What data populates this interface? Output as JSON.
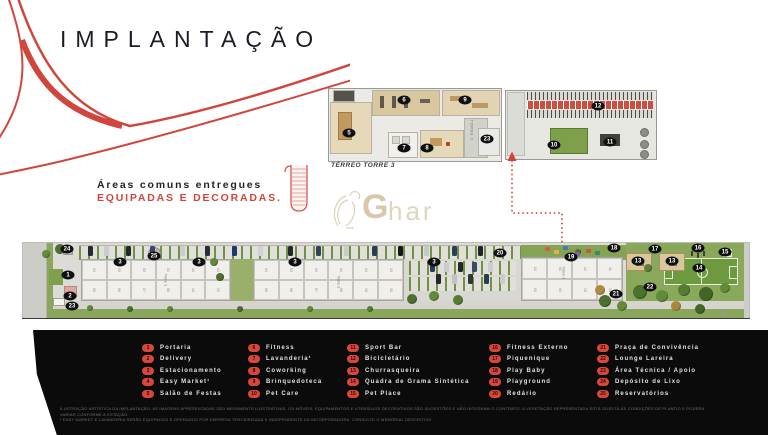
{
  "title": "IMPLANTAÇÃO",
  "tagline": {
    "line1": "Áreas comuns entregues",
    "line2": "EQUIPADAS E DECORADAS."
  },
  "watermark": {
    "bold": "G",
    "light": "har"
  },
  "colors": {
    "accent_red": "#d0453c",
    "footer_bg": "#0b0b0b",
    "gold": "#bfa374",
    "grass": "#8aa65c",
    "field_green": "#6d9a3e",
    "marker_black": "#0f0f0f"
  },
  "floorplan": {
    "caption": "TÉRREO TORRE 3",
    "tower_label": "TORRE 3",
    "markers": [
      {
        "n": "5",
        "x": 349,
        "y": 133
      },
      {
        "n": "6",
        "x": 404,
        "y": 100
      },
      {
        "n": "7",
        "x": 404,
        "y": 148
      },
      {
        "n": "8",
        "x": 427,
        "y": 148
      },
      {
        "n": "9",
        "x": 465,
        "y": 100
      },
      {
        "n": "23",
        "x": 487,
        "y": 139
      },
      {
        "n": "10",
        "x": 554,
        "y": 145
      },
      {
        "n": "11",
        "x": 610,
        "y": 142
      },
      {
        "n": "12",
        "x": 598,
        "y": 106
      }
    ]
  },
  "siteplan": {
    "tower_labels": [
      {
        "label": "Torre 1",
        "x": 166,
        "y": 280
      },
      {
        "label": "Torre 2",
        "x": 339,
        "y": 282
      },
      {
        "label": "Torre 3",
        "x": 564,
        "y": 273
      }
    ],
    "markers": [
      {
        "n": "24",
        "x": 67,
        "y": 249
      },
      {
        "n": "3",
        "x": 120,
        "y": 262
      },
      {
        "n": "25",
        "x": 154,
        "y": 256
      },
      {
        "n": "3",
        "x": 199,
        "y": 262
      },
      {
        "n": "1",
        "x": 68,
        "y": 275
      },
      {
        "n": "2",
        "x": 70,
        "y": 296
      },
      {
        "n": "23",
        "x": 72,
        "y": 306
      },
      {
        "n": "3",
        "x": 295,
        "y": 262
      },
      {
        "n": "3",
        "x": 434,
        "y": 262
      },
      {
        "n": "20",
        "x": 500,
        "y": 253
      },
      {
        "n": "19",
        "x": 571,
        "y": 257
      },
      {
        "n": "18",
        "x": 614,
        "y": 248
      },
      {
        "n": "17",
        "x": 655,
        "y": 249
      },
      {
        "n": "16",
        "x": 698,
        "y": 248
      },
      {
        "n": "15",
        "x": 725,
        "y": 252
      },
      {
        "n": "13",
        "x": 638,
        "y": 261
      },
      {
        "n": "13",
        "x": 672,
        "y": 261
      },
      {
        "n": "14",
        "x": 699,
        "y": 268
      },
      {
        "n": "22",
        "x": 650,
        "y": 287
      },
      {
        "n": "21",
        "x": 616,
        "y": 294
      }
    ],
    "buildings": [
      {
        "x": 58,
        "y": 16,
        "w": 150,
        "h": 42,
        "units_top": [
          "04",
          "03",
          "03",
          "01",
          "14",
          "13"
        ],
        "units_bottom": [
          "05",
          "06",
          "07",
          "08",
          "16",
          "15"
        ]
      },
      {
        "x": 230,
        "y": 16,
        "w": 151,
        "h": 42,
        "units_top": [
          "04",
          "03",
          "02",
          "01",
          "14",
          "13"
        ],
        "units_bottom": [
          "05",
          "06",
          "07",
          "08",
          "16",
          "15"
        ]
      },
      {
        "x": 498,
        "y": 14,
        "w": 102,
        "h": 44,
        "units_top": [
          "02",
          "01",
          "12",
          "11"
        ],
        "units_bottom": [
          "03",
          "04",
          "13",
          "14"
        ]
      }
    ],
    "cars": [
      {
        "x": 88,
        "y": 246,
        "c": "#262b33"
      },
      {
        "x": 104,
        "y": 246,
        "c": "#c9cbcd"
      },
      {
        "x": 126,
        "y": 246,
        "c": "#1f2730"
      },
      {
        "x": 150,
        "y": 246,
        "c": "#3a4a66"
      },
      {
        "x": 180,
        "y": 246,
        "c": "#caccce"
      },
      {
        "x": 205,
        "y": 246,
        "c": "#2a2f36"
      },
      {
        "x": 232,
        "y": 246,
        "c": "#1d3a6b"
      },
      {
        "x": 258,
        "y": 246,
        "c": "#cfd1d2"
      },
      {
        "x": 288,
        "y": 246,
        "c": "#23272c"
      },
      {
        "x": 316,
        "y": 246,
        "c": "#33405a"
      },
      {
        "x": 344,
        "y": 246,
        "c": "#c9cbcd"
      },
      {
        "x": 372,
        "y": 246,
        "c": "#2c3b57"
      },
      {
        "x": 398,
        "y": 246,
        "c": "#14161a"
      },
      {
        "x": 424,
        "y": 246,
        "c": "#c5c7c9"
      },
      {
        "x": 452,
        "y": 246,
        "c": "#2e3d5c"
      },
      {
        "x": 478,
        "y": 246,
        "c": "#1f242b"
      },
      {
        "x": 430,
        "y": 262,
        "c": "#2b3a55"
      },
      {
        "x": 444,
        "y": 262,
        "c": "#c9cbcd"
      },
      {
        "x": 458,
        "y": 262,
        "c": "#23272c"
      },
      {
        "x": 472,
        "y": 262,
        "c": "#3a4a66"
      },
      {
        "x": 488,
        "y": 262,
        "c": "#caccce"
      },
      {
        "x": 436,
        "y": 274,
        "c": "#1f2730"
      },
      {
        "x": 452,
        "y": 274,
        "c": "#c0c2c4"
      },
      {
        "x": 468,
        "y": 274,
        "c": "#30363d"
      },
      {
        "x": 484,
        "y": 274,
        "c": "#2b3a55"
      },
      {
        "x": 500,
        "y": 274,
        "c": "#c9cbcd"
      }
    ],
    "trees": [
      {
        "x": 60,
        "y": 249,
        "r": 5,
        "c": "#4c7030"
      },
      {
        "x": 46,
        "y": 254,
        "r": 4,
        "c": "#628a3a"
      },
      {
        "x": 214,
        "y": 262,
        "r": 4,
        "c": "#628a3a"
      },
      {
        "x": 220,
        "y": 277,
        "r": 4,
        "c": "#4c7030"
      },
      {
        "x": 412,
        "y": 299,
        "r": 5,
        "c": "#4c7030"
      },
      {
        "x": 434,
        "y": 296,
        "r": 5,
        "c": "#628a3a"
      },
      {
        "x": 458,
        "y": 300,
        "r": 5,
        "c": "#547c33"
      },
      {
        "x": 578,
        "y": 252,
        "r": 3,
        "c": "#4c7030"
      },
      {
        "x": 605,
        "y": 301,
        "r": 6,
        "c": "#4c7030"
      },
      {
        "x": 622,
        "y": 306,
        "r": 5,
        "c": "#628a3a"
      },
      {
        "x": 640,
        "y": 292,
        "r": 7,
        "c": "#4c7030"
      },
      {
        "x": 662,
        "y": 296,
        "r": 6,
        "c": "#628a3a"
      },
      {
        "x": 684,
        "y": 290,
        "r": 6,
        "c": "#547c33"
      },
      {
        "x": 706,
        "y": 294,
        "r": 7,
        "c": "#436628"
      },
      {
        "x": 725,
        "y": 288,
        "r": 5,
        "c": "#628a3a"
      },
      {
        "x": 648,
        "y": 268,
        "r": 4,
        "c": "#5d8038"
      },
      {
        "x": 600,
        "y": 290,
        "r": 5,
        "c": "#b08a45"
      },
      {
        "x": 676,
        "y": 306,
        "r": 5,
        "c": "#a8883f"
      },
      {
        "x": 90,
        "y": 308,
        "r": 3,
        "c": "#628a3a"
      },
      {
        "x": 130,
        "y": 309,
        "r": 3,
        "c": "#4c7030"
      },
      {
        "x": 170,
        "y": 309,
        "r": 3,
        "c": "#628a3a"
      },
      {
        "x": 240,
        "y": 309,
        "r": 3,
        "c": "#4c7030"
      },
      {
        "x": 310,
        "y": 309,
        "r": 3,
        "c": "#628a3a"
      },
      {
        "x": 370,
        "y": 309,
        "r": 3,
        "c": "#547c33"
      },
      {
        "x": 700,
        "y": 309,
        "r": 5,
        "c": "#436628"
      }
    ],
    "play_items": [
      {
        "x": 545,
        "y": 247,
        "c": "#d65a4a"
      },
      {
        "x": 554,
        "y": 250,
        "c": "#e8b23c"
      },
      {
        "x": 563,
        "y": 246,
        "c": "#4a76b8"
      },
      {
        "x": 586,
        "y": 249,
        "c": "#cc5344"
      },
      {
        "x": 595,
        "y": 251,
        "c": "#3a8a5c"
      },
      {
        "x": 575,
        "y": 252,
        "c": "#8a5fb0"
      }
    ]
  },
  "legend": {
    "column_x": [
      142,
      248,
      347,
      489,
      597
    ],
    "per_column": 5,
    "items": [
      {
        "n": "1",
        "label": "Portaria"
      },
      {
        "n": "2",
        "label": "Delivery"
      },
      {
        "n": "3",
        "label": "Estacionamento"
      },
      {
        "n": "4",
        "label": "Easy Market¹"
      },
      {
        "n": "5",
        "label": "Salão de Festas"
      },
      {
        "n": "6",
        "label": "Fitness"
      },
      {
        "n": "7",
        "label": "Lavanderia¹"
      },
      {
        "n": "8",
        "label": "Coworking"
      },
      {
        "n": "9",
        "label": "Brinquedoteca"
      },
      {
        "n": "10",
        "label": "Pet Care"
      },
      {
        "n": "11",
        "label": "Sport Bar"
      },
      {
        "n": "12",
        "label": "Bicicletário"
      },
      {
        "n": "13",
        "label": "Churrasqueira"
      },
      {
        "n": "14",
        "label": "Quadra de Grama Sintética"
      },
      {
        "n": "15",
        "label": "Pet Place"
      },
      {
        "n": "16",
        "label": "Fitness Externo"
      },
      {
        "n": "17",
        "label": "Piquenique"
      },
      {
        "n": "18",
        "label": "Play Baby"
      },
      {
        "n": "19",
        "label": "Playground"
      },
      {
        "n": "20",
        "label": "Redário"
      },
      {
        "n": "21",
        "label": "Praça de Convivência"
      },
      {
        "n": "22",
        "label": "Lounge Lareira"
      },
      {
        "n": "23",
        "label": "Área Técnica / Apoio"
      },
      {
        "n": "24",
        "label": "Depósito de Lixo"
      },
      {
        "n": "25",
        "label": "Reservatórios"
      }
    ]
  },
  "disclaimer": {
    "line1": "ILUSTRAÇÃO ARTÍSTICA DA IMPLANTAÇÃO. AS IMAGENS APRESENTADAS SÃO MERAMENTE ILUSTRATIVAS. OS MÓVEIS, EQUIPAMENTOS E UTENSÍLIOS DECORATIVOS SÃO SUGESTÕES E NÃO INTEGRAM O CONTRATO. A VEGETAÇÃO REPRESENTADA ESTÁ SUJEITA ÀS CONDIÇÕES DE PLANTIO E PODERÁ VARIAR CONFORME A ESTAÇÃO.",
    "line2": "¹ EASY MARKET E LAVANDERIA SERÃO EQUIPADOS E OPERADOS POR EMPRESA TERCEIRIZADA E INDEPENDENTE DA INCORPORADORA. CONSULTE O MEMORIAL DESCRITIVO."
  }
}
